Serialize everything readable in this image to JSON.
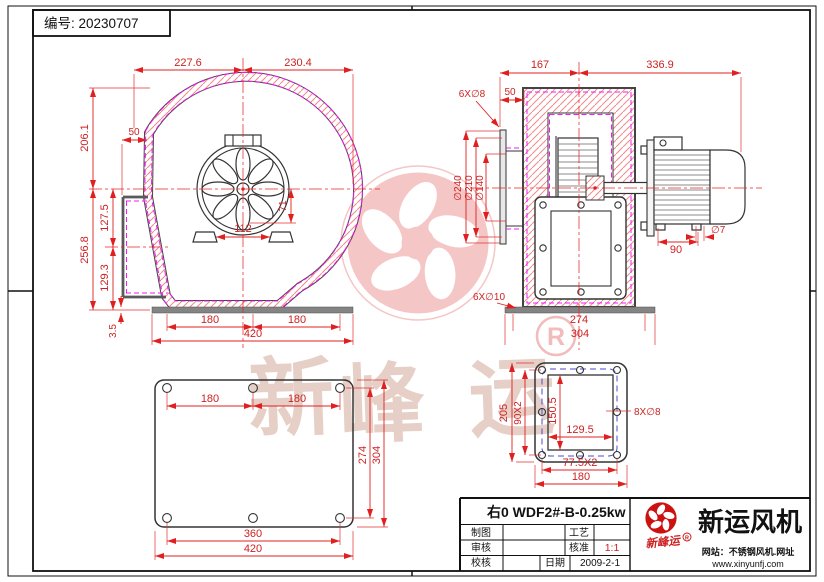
{
  "doc": {
    "number_label": "编号: 20230707"
  },
  "front_view": {
    "dim_top_left": "227.6",
    "dim_top_right": "230.4",
    "dim_offset_50": "50",
    "dim_height_upper": "206.1",
    "dim_height_lower": "256.8",
    "dim_outlet_center": "127.5",
    "dim_outlet_lower": "129.3",
    "dim_base_thickness": "3.5",
    "dim_inlet_radius": "71",
    "dim_feet_span": "112",
    "dim_bolt_left": "180",
    "dim_bolt_right": "180",
    "dim_base_width": "420"
  },
  "side_view": {
    "dim_167": "167",
    "dim_336_9": "336.9",
    "dim_50": "50",
    "label_inlet_holes": "6X∅8",
    "dia_240": "∅240",
    "dia_210": "∅210",
    "dia_140": "∅140",
    "dim_motor_feet": "90",
    "label_foot_hole": "∅7",
    "label_base_holes": "6X∅10",
    "dim_bolt_274": "274",
    "dim_base_304": "304"
  },
  "base_view": {
    "dim_bolt_left": "180",
    "dim_bolt_right": "180",
    "dim_bolt_vert": "274",
    "dim_plate_height": "304",
    "dim_bolt_width": "360",
    "dim_plate_width": "420"
  },
  "flange_view": {
    "dim_outer_height": "205",
    "dim_bolt_vert": "90X2",
    "dim_opening_height": "150.5",
    "dim_opening_width": "129.5",
    "dim_bolt_width": "77.5X2",
    "dim_outer_width": "180",
    "label_holes": "8X∅8"
  },
  "watermark": {
    "char1": "新",
    "char2": "峰",
    "char3": "运",
    "registered": "R"
  },
  "title_block": {
    "model": "右0 WDF2#-B-0.25kw",
    "drafter_label": "制图",
    "reviewer_label": "审核",
    "checker_label": "校核",
    "process_label": "工艺",
    "approve_label": "核准",
    "scale_value": "1:1",
    "date_label": "日期",
    "date_value": "2009-2-1",
    "company_name": "新运风机",
    "stamp_text": "新峰运",
    "registered": "R",
    "website_line": "网站：不锈钢风机.网址",
    "url": "www.xinyunfj.com"
  },
  "colors": {
    "dim_red": "#e02020",
    "hatch_red": "#f08a8a",
    "magenta": "#f219f2",
    "blue_dash": "#4c4ccc",
    "watermark_pink": "#f5c6c6",
    "logo_red": "#cc1111"
  }
}
